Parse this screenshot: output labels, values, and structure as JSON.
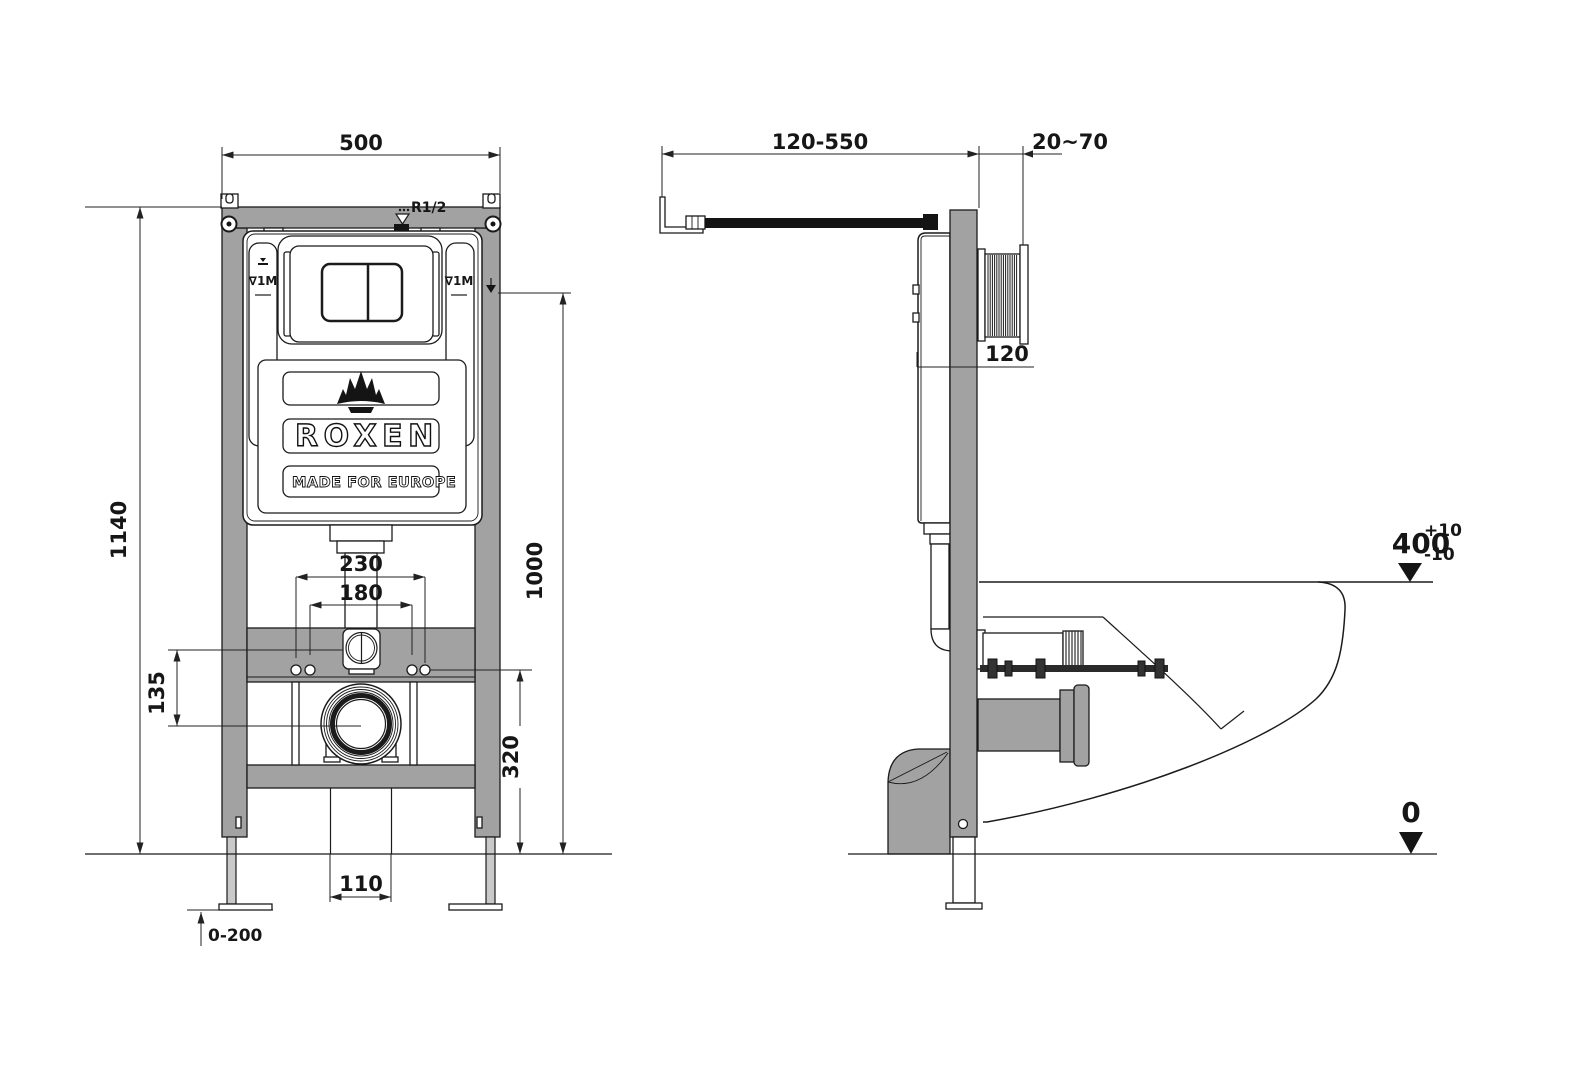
{
  "front": {
    "dim_width": "500",
    "dim_height": "1140",
    "dim_flush_height": "1000",
    "dim_inlet_span": "230",
    "dim_bolt_span": "180",
    "dim_inlet_outlet": "135",
    "dim_outlet_height": "320",
    "dim_drain_width": "110",
    "dim_leg_range": "0-200",
    "inlet_thread": "R1/2",
    "tank_mark_left": "∇1M",
    "tank_mark_right": "∇1M",
    "brand": "ROXEN",
    "tagline": "MADE FOR EUROPE"
  },
  "side": {
    "dim_supply_reach": "120-550",
    "dim_wall_finish": "20~70",
    "dim_frame_depth": "120",
    "dim_rim_height": "400",
    "rim_tol_plus": "+10",
    "rim_tol_minus": "-10",
    "floor_level": "0"
  }
}
